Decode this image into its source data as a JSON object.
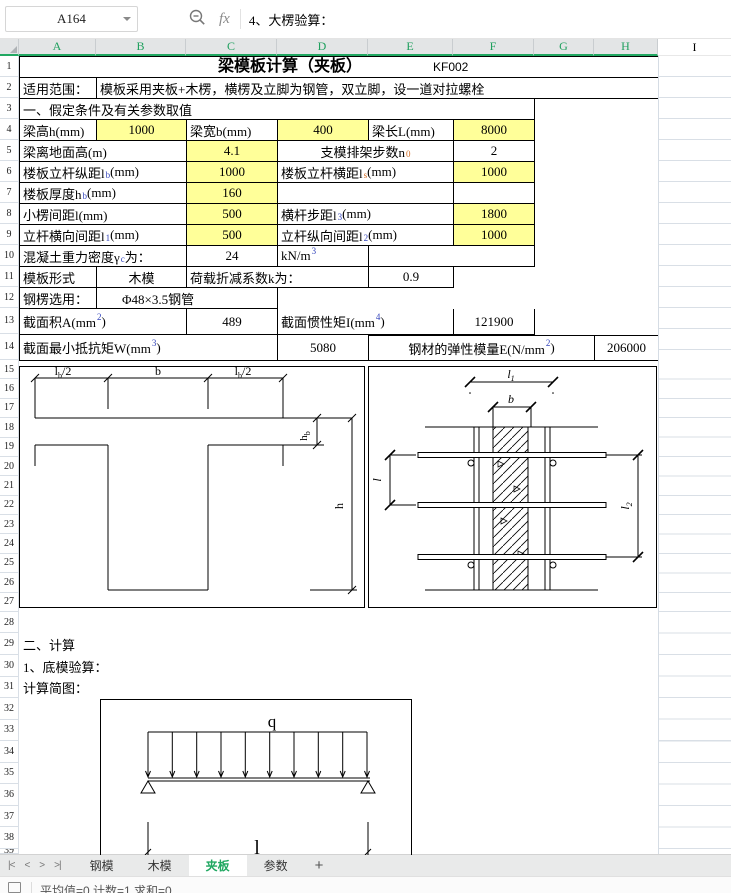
{
  "toolbar": {
    "name_box": "A164",
    "fx_label": "fx",
    "formula": "4、大楞验算："
  },
  "columns": [
    "A",
    "B",
    "C",
    "D",
    "E",
    "F",
    "G",
    "H",
    "I"
  ],
  "row_numbers": [
    "1",
    "2",
    "3",
    "4",
    "5",
    "6",
    "7",
    "8",
    "9",
    "10",
    "11",
    "12",
    "13",
    "14",
    "15",
    "16",
    "17",
    "18",
    "19",
    "20",
    "21",
    "22",
    "23",
    "24",
    "25",
    "26",
    "27",
    "28",
    "29",
    "30",
    "31",
    "32",
    "33",
    "34",
    "35",
    "36",
    "37",
    "38",
    "39"
  ],
  "sheet": {
    "r1": {
      "title": "梁模板计算（夹板）",
      "code": "KF002"
    },
    "r2": {
      "a": "适用范围：",
      "b": "模板采用夹板+木楞，横楞及立脚为钢管，双立脚，设一道对拉螺栓"
    },
    "r3": {
      "a": "一、假定条件及有关参数取值"
    },
    "r4": {
      "l1": "梁高h(mm)",
      "v1": "1000",
      "l2": "梁宽b(mm)",
      "v2": "400",
      "l3": "梁长L(mm)",
      "v3": "8000"
    },
    "r5": {
      "l1": "梁离地面高(m)",
      "v1": "4.1",
      "l2a": "支模排架步数n",
      "l2sub": "0",
      "v2": "2"
    },
    "r6": {
      "l1a": "楼板立杆纵距l",
      "l1sub": "b",
      "l1b": "(mm)",
      "v1": "1000",
      "l2a": "楼板立杆横距l",
      "l2sub": "s",
      "l2b": "(mm)",
      "v2": "1000"
    },
    "r7": {
      "l1a": "楼板厚度h",
      "l1sub": "b",
      "l1b": "(mm)",
      "v1": "160"
    },
    "r8": {
      "l1": "小楞间距l(mm)",
      "v1": "500",
      "l2a": "横杆步距l",
      "l2sub": "3",
      "l2b": "(mm)",
      "v2": "1800"
    },
    "r9": {
      "l1a": "立杆横向间距l",
      "l1sub": "1",
      "l1b": "(mm)",
      "v1": "500",
      "l2a": "立杆纵向间距l",
      "l2sub": "2",
      "l2b": "(mm)",
      "v2": "1000"
    },
    "r10": {
      "l1a": "混凝土重力密度γ",
      "l1sub": "c",
      "l1b": "为：",
      "v1": "24",
      "unita": "kN/m",
      "unitsup": "3"
    },
    "r11": {
      "l1": "模板形式",
      "v1": "木模",
      "l2": "荷载折减系数k为：",
      "v2": "0.9"
    },
    "r12": {
      "l1": "钢楞选用：",
      "v1": "Φ48×3.5钢管"
    },
    "r13": {
      "l1a": "截面积A(mm",
      "l1sup": "2",
      "l1b": ")",
      "v1": "489",
      "l2a": "截面惯性矩I(mm",
      "l2sup": "4",
      "l2b": ")",
      "v2": "121900"
    },
    "r14": {
      "l1a": "截面最小抵抗矩W(mm",
      "l1sup": "3",
      "l1b": ")",
      "v1": "5080",
      "l2a": "钢材的弹性模量E(N/mm",
      "l2sup": "2",
      "l2b": ")",
      "v2": "206000"
    },
    "r29": {
      "a": "二、计算"
    },
    "r30": {
      "a": "1、底模验算："
    },
    "r31": {
      "a": "计算简图："
    }
  },
  "diag_section": {
    "dim_left_main": "l",
    "dim_left_sub": "b",
    "dim_left_tail": "/2",
    "dim_mid": "b",
    "dim_right_main": "l",
    "dim_right_sub": "b",
    "dim_right_tail": "/2",
    "dim_hb_main": "h",
    "dim_hb_sub": "b",
    "dim_h": "h"
  },
  "diag_plan": {
    "dim_l1_main": "l",
    "dim_l1_sub": "1",
    "dim_b": "b",
    "dim_l": "l",
    "dim_l2_main": "l",
    "dim_l2_sub": "2"
  },
  "diag_beam": {
    "load": "q",
    "span": "l"
  },
  "tabbar": {
    "nav_first": "|<",
    "nav_prev": "<",
    "nav_next": ">",
    "nav_last": ">|",
    "t1": "钢模",
    "t2": "木模",
    "t3": "夹板",
    "t4": "参数",
    "add": "+"
  },
  "statusbar": {
    "text": "平均值=0  计数=1  求和=0"
  },
  "colors": {
    "accent_green": "#21A862",
    "fill_yellow": "#FFFF99",
    "sub_blue": "#3344BB",
    "sub_orange": "#D2691E"
  }
}
